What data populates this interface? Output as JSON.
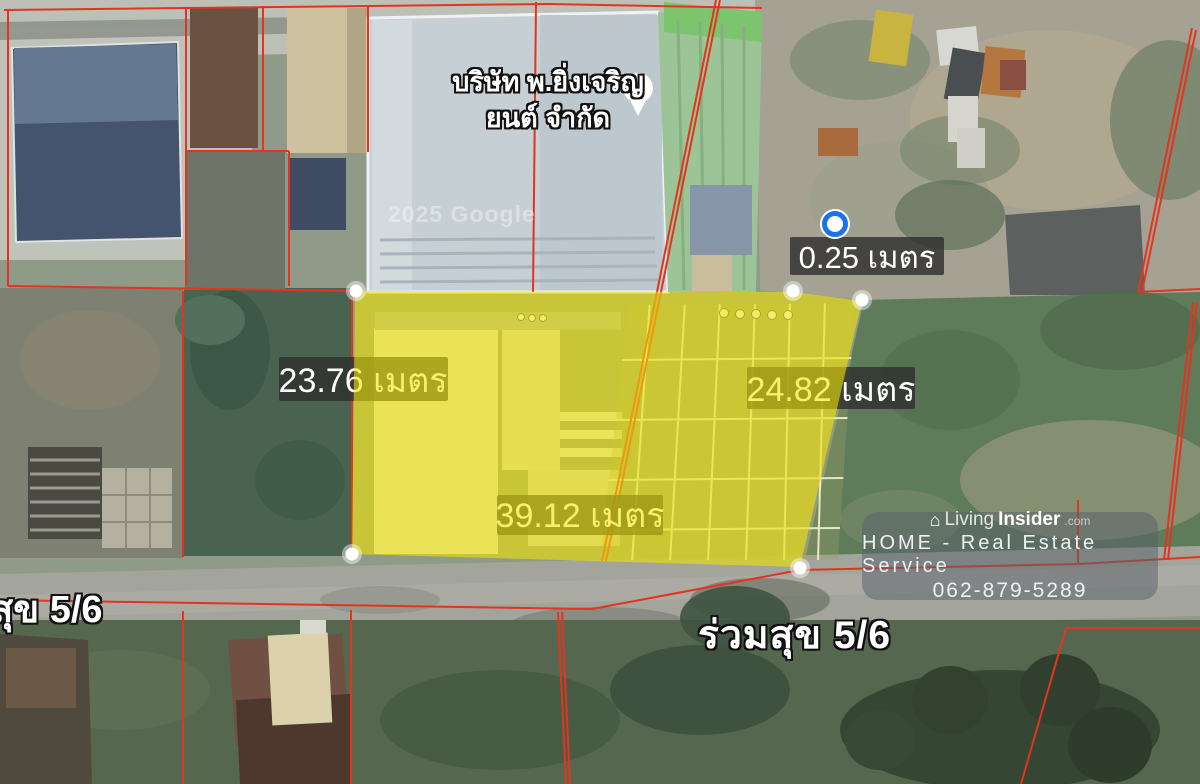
{
  "map": {
    "place": {
      "name_line1": "บริษัท พ.ยิ่งเจริญ",
      "name_line2": "ยนต์ จำกัด"
    },
    "copyright": "2025 Google",
    "measurements": {
      "north_gap": "0.25 เมตร",
      "west_side": "23.76 เมตร",
      "east_side": "24.82 เมตร",
      "south_side": "39.12 เมตร"
    },
    "roads": {
      "left": "สุข 5/6",
      "main": "ร่วมสุข 5/6"
    },
    "colors": {
      "plot_highlight": "#f2e600",
      "boundary_line": "#e23420",
      "measure_label_bg": "#2f2f2f",
      "measure_label_text": "#ffffff",
      "marker_blue": "#1a73e8",
      "marker_white": "#ffffff"
    }
  },
  "watermark": {
    "brand_prefix": "Living",
    "brand_suffix": "Insider",
    "brand_tld": ".com",
    "tagline": "HOME - Real Estate Service",
    "phone": "062-879-5289"
  }
}
